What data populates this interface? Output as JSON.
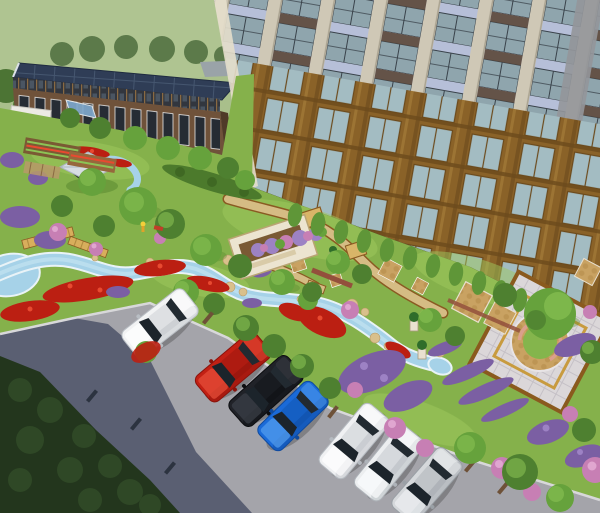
{
  "scene": {
    "type": "3d-architectural-rendering",
    "view": "aerial-perspective",
    "subject": "residential community courtyard landscape design",
    "elements": [
      "flat green terrain background",
      "low office building with dark blue solar-panel roof and brick facade",
      "high-rise apartment tower with cream piers, glass bays and bronze lower frames",
      "central garden with winding light-blue stream, rocks and pond",
      "red, purple and pink flower beds",
      "white rectangular planter with purple flowers",
      "gazebo with light gray hip roof",
      "garden plots and pergola area",
      "paved plaza with diamond tile grid, golden inner border, cobble circle and central tree",
      "tan walkways, cobble pads and wooden boardwalk",
      "asphalt road with long tree shadow and dark hedge mass",
      "angle-parked cars along the curb",
      "wheel stops on parking stalls",
      "small person figure and red bench in playground area"
    ],
    "vehicle_inventory": "7 cars: white SUV, red SUV, black sedan, blue hatchback, two white sedans, silver sedan"
  },
  "palette": {
    "bg_grass": "#a9bf8b",
    "bg_grass_light": "#b6ca97",
    "tree_bg": "#5c7a4a",
    "tree_edge": "#4c7434",
    "tree_dark": "#4e8030",
    "tree_mid": "#66a23c",
    "tree_light": "#8cc455",
    "tree_row": "#5f9638",
    "trunk": "#6b4a2a",
    "office_roof": "#2f3d56",
    "office_roof_line": "#45566f",
    "office_fascia": "#32363e",
    "office_fascia_lite": "#4a5562",
    "office_mullion": "#8a6a42",
    "office_brick": "#6f523a",
    "office_window": "#262c34",
    "office_end": "#4f3a28",
    "canopy": "#7fa8cc",
    "annex_white": "#eceae4",
    "annex_gray": "#9aa3a8",
    "hr_pier": "#cfc8b6",
    "hr_pier_shade": "#a9a290",
    "hr_glass": "#8fa5ad",
    "hr_mullion": "#39424a",
    "hr_spandrel": "#b6bfd8",
    "hr_spandrel_line": "#9aa2b8",
    "hr_brown": "#5d4a3c",
    "hr_bronze": "#8a6228",
    "hr_bronze_hi": "#9c7434",
    "hr_bronze_dark": "#6b4a1c",
    "hr_bronze_glass": "#a3bcc2",
    "hr_corner": "#94969a",
    "hr_base": "#43311d",
    "hr_edge": "#e4decb",
    "hr_baseline": "#3a2c1a",
    "lawn": "#85b14b",
    "lawn_light": "#9ec85e",
    "lawn_shade": "#55862e",
    "hedge": "#4c7a2c",
    "hedge_tex": "#3f6823",
    "path_edge": "#8a5a22",
    "path_tan": "#d5bc84",
    "pad_cobble": "#c9a262",
    "pad_dot": "#b8904f",
    "boardwalk": "#d8ae5c",
    "plank": "#b08a3e",
    "mosaic": "#d9b568",
    "stream": "#a6d2e8",
    "stream_edge": "#e9f3f7",
    "stream_hi": "#c8e6f2",
    "rock": "#d9c08c",
    "rock_edge": "#b89a66",
    "fl_red": "#bb1f12",
    "fl_red_hi": "#e84a30",
    "fl_purple": "#7b5fa3",
    "fl_purple_hi": "#9d82c4",
    "fl_pink": "#c77fb4",
    "fl_pink_hi": "#e0a6d0",
    "planter_white": "#ece4d0",
    "planter_edge": "#b9a472",
    "soil": "#7a5a34",
    "gazebo_roof": "#d7dde2",
    "gazebo_ridge": "#aeb6c0",
    "gazebo_dark": "#2f3a2c",
    "wall_brick": "#93503c",
    "pillar": "#e9e1d0",
    "pillar_edge": "#a89a7a",
    "topiary": "#2f6d2a",
    "plaza_tile": "#dbd7d9",
    "plaza_grid": "#c5c0c6",
    "plaza_border": "#8a5a1e",
    "plaza_gold": "#c89b3f",
    "plaza_green": "#84b54c",
    "plaza_wall": "#db9f8c",
    "road": "#a4a4aa",
    "road_shadow": "#4d5468",
    "hedge_dark": "#23361d",
    "hedge_dot": "#2f4826",
    "curb": "#d8d8da",
    "stop": "#6e5138",
    "stop_dark": "#2c3340",
    "car_glass": "#1c242b",
    "car_glass_rear": "#222a31",
    "person": "#f2cf3a",
    "bench": "#c23c28"
  },
  "cars": [
    {
      "name": "white-suv",
      "body": "#f2f3f4",
      "shade": "#b9bec4",
      "light": "#ffffff"
    },
    {
      "name": "red-suv",
      "body": "#c22014",
      "shade": "#8a130c",
      "light": "#e8503a"
    },
    {
      "name": "black-sedan",
      "body": "#202228",
      "shade": "#0c0d10",
      "light": "#3c4048"
    },
    {
      "name": "blue-hatchback",
      "body": "#1a6ad8",
      "shade": "#0f4a9e",
      "light": "#55a0f0"
    },
    {
      "name": "white-sedan-1",
      "body": "#f0f1f3",
      "shade": "#b5bac0",
      "light": "#ffffff"
    },
    {
      "name": "white-sedan-2",
      "body": "#eceef0",
      "shade": "#aeb3b9",
      "light": "#fbfcfd"
    },
    {
      "name": "silver-sedan",
      "body": "#d5d8db",
      "shade": "#9aa0a6",
      "light": "#edf0f2"
    }
  ]
}
